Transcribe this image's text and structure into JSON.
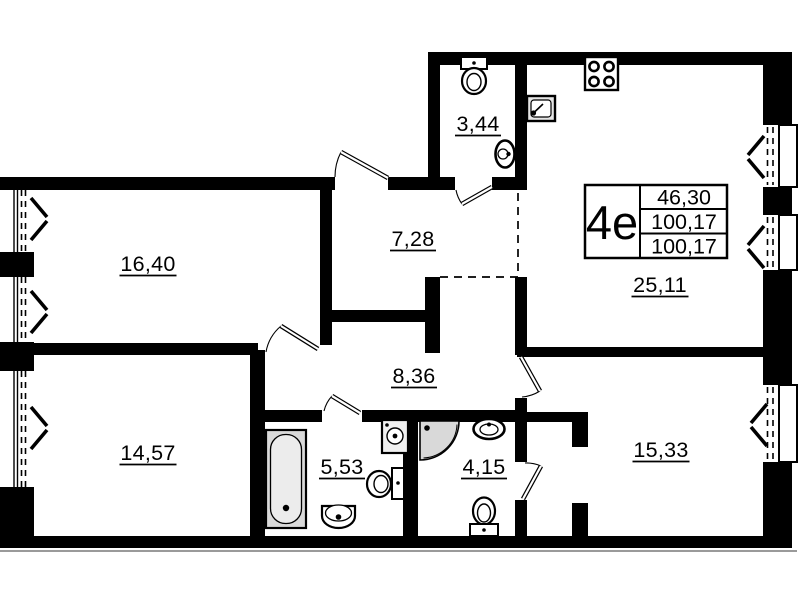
{
  "plan": {
    "stamp": {
      "unit_type": "4e",
      "area_1": "46,30",
      "area_2": "100,17",
      "area_3": "100,17"
    },
    "rooms": [
      {
        "name": "living-room",
        "area": "16,40"
      },
      {
        "name": "wc",
        "area": "3,44"
      },
      {
        "name": "hall",
        "area": "7,28"
      },
      {
        "name": "kitchen-living-room",
        "area": "25,11"
      },
      {
        "name": "corridor",
        "area": "8,36"
      },
      {
        "name": "bedroom-1",
        "area": "14,57"
      },
      {
        "name": "bathroom",
        "area": "5,53"
      },
      {
        "name": "shower-room",
        "area": "4,15"
      },
      {
        "name": "bedroom-2",
        "area": "15,33"
      }
    ],
    "fixtures": [
      "toilet-icon",
      "washbasin-icon",
      "kitchen-sink-icon",
      "stove-icon",
      "bathtub-icon",
      "washing-machine-icon",
      "shower-cabin-icon"
    ],
    "colors": {
      "walls": "#000000",
      "background": "#ffffff",
      "fixture_fill": "#d9d9d9"
    }
  }
}
